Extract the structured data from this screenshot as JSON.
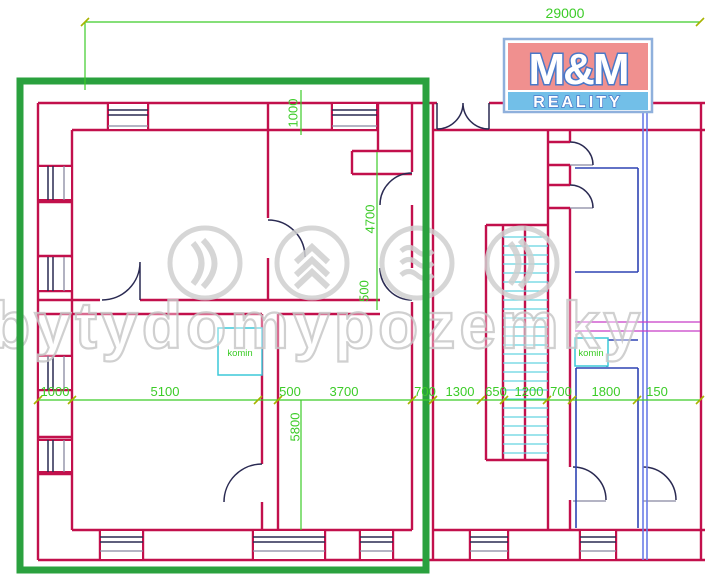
{
  "watermark": {
    "text": "bytydomypozemky"
  },
  "logo": {
    "top": "M&M",
    "bottom": "REALITY"
  },
  "labels": {
    "komin_left": "komin",
    "komin_right": "komin"
  },
  "dimensions": {
    "overall_width": "29000",
    "top_wall": "1000",
    "hall_height": "4700",
    "mid_wall": "500",
    "room_height": "5800",
    "bottom_row": [
      "1000",
      "5100",
      "500",
      "3700",
      "700",
      "1300",
      "650",
      "1200",
      "700",
      "1800",
      "150"
    ]
  },
  "colors": {
    "wall_crimson": "#c2104c",
    "dim_green": "#3ccc28",
    "highlight_green": "#2aa13e",
    "window_navy": "#2a2a52",
    "blue_wall": "#2f44b4",
    "light_blue": "#6b7ce8",
    "cyan": "#3cc8d8",
    "stair_cyan": "#63d4e0",
    "magenta": "#c83cc8",
    "watermark_gray": "#c8c8c8",
    "logo_pink": "#f0908f",
    "logo_blue": "#72bfe8"
  }
}
